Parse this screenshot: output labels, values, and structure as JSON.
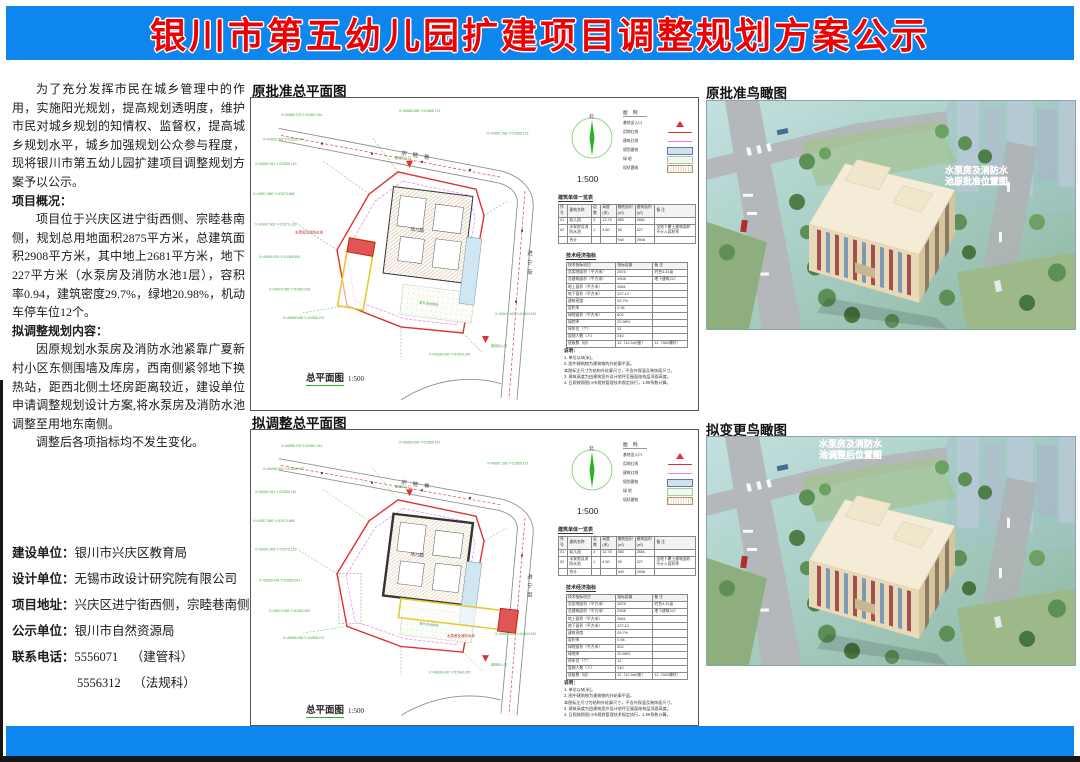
{
  "banner": {
    "title": "银川市第五幼儿园扩建项目调整规划方案公示",
    "bg_color": "#0d86ee",
    "title_color": "#ee0000"
  },
  "intro": {
    "p1": "为了充分发挥市民在城乡管理中的作用，实施阳光规划，提高规划透明度，维护市民对城乡规划的知情权、监督权，提高城乡规划水平，城乡加强规划公众参与程度，现将银川市第五幼儿园扩建项目调整规划方案予以公示。",
    "h1": "项目概况：",
    "p2": "项目位于兴庆区进宁街西侧、宗睦巷南侧，规划总用地面积2875平方米，总建筑面积2908平方米，其中地上2681平方米，地下227平方米（水泵房及消防水池1层），容积率0.94，建筑密度29.7%，绿地20.98%，机动车停车位12个。",
    "h2": "拟调整规划内容：",
    "p3": "因原规划水泵房及消防水池紧靠广夏新村小区东侧围墙及库房，西南侧紧邻地下换热站，距西北侧土坯房距离较近，建设单位申请调整规划设计方案,将水泵房及消防水池调整至用地东南侧。",
    "p4": "调整后各项指标均不发生变化。"
  },
  "info": {
    "rows": [
      [
        "建设单位：",
        "银川市兴庆区教育局"
      ],
      [
        "设计单位：",
        "无锡市政设计研究院有限公司"
      ],
      [
        "项目地址：",
        "兴庆区进宁街西侧，宗睦巷南侧"
      ],
      [
        "公示单位：",
        "银川市自然资源局"
      ]
    ],
    "phone_label": "联系电话：",
    "phone1": "5556071",
    "phone1_dept": "（建管科）",
    "phone2": "5556312",
    "phone2_dept": "（法规科）",
    "date_label": "公示时间：",
    "date_value": "2023年4月18日至2023年4月25日"
  },
  "sections": {
    "plan1": "原批准总平面图",
    "plan2": "拟调整总平面图",
    "bird1": "原批准鸟瞰图",
    "bird2": "拟变更鸟瞰图"
  },
  "plan": {
    "caption": "总平面图",
    "scale": "1:500",
    "north_label": "北",
    "streets": {
      "north": "宗睦巷",
      "east": "进宁街"
    },
    "entrance_label": "基地出入口",
    "building_label": "幼儿园",
    "pump_label": "水泵房及消防水池",
    "playground_label": "室外活动场地",
    "legend": {
      "title": "图 例",
      "items": [
        "基地出入口",
        "用地红线",
        "建筑红线",
        "规划建筑",
        "绿  地",
        "现状建筑"
      ]
    },
    "table1": {
      "title": "建筑单体一览表",
      "rows": [
        [
          "序号",
          "建筑名称",
          "层数",
          "高度(米)",
          "基底面积(㎡)",
          "建筑面积(㎡)",
          "备 注"
        ],
        [
          "01",
          "幼儿园",
          "3",
          "12.75",
          "850",
          "2681",
          ""
        ],
        [
          "02",
          "水泵房及消防水池",
          "1",
          "4.50",
          "90",
          "227",
          "全地下覆土建筑面积不计入容积率"
        ],
        [
          "",
          "合计",
          "",
          "",
          "940",
          "2908",
          ""
        ]
      ]
    },
    "table2": {
      "title": "技术经济指标",
      "rows": [
        [
          "技术指标项目",
          "指标容量",
          "备 注"
        ],
        [
          "总用地面积（平方米）",
          "2875",
          "约合4.31亩"
        ],
        [
          "总建筑面积（平方米）",
          "2908",
          "地下建筑227"
        ],
        [
          "地上面积（平方米）",
          "2681",
          ""
        ],
        [
          "地下面积（平方米）",
          "227.12",
          ""
        ],
        [
          "建筑密度",
          "29.7%",
          ""
        ],
        [
          "容积率",
          "0.94",
          ""
        ],
        [
          "绿地面积（平方米）",
          "602",
          ""
        ],
        [
          "绿地率",
          "20.98%",
          ""
        ],
        [
          "停车位（个）",
          "12",
          ""
        ],
        [
          "容纳人数（人）",
          "240",
          ""
        ],
        [
          "班级数（班）",
          "12（12.5㎡/座）",
          "12（360课时）"
        ]
      ]
    },
    "notes": {
      "title": "说明：",
      "items": [
        "1. 单位以M(米)。",
        "2. 图中建筑物为建筑物的外轮廓平面。",
        "本图标注尺寸为结构外轮廓尺寸，不含外保温及装饰面尺寸。",
        "3. 建筑高度为由建筑室外设计地坪至屋面结构层顶面高度。",
        "4. 日照按照银川市规划管理技术规定执行，1.99系数计算。"
      ]
    },
    "coords": [
      "X=40858.375 Y=51561.044",
      "X=40806.594 Y=51562.347",
      "X=40801.061 Y=51559.140",
      "X=40817.880 Y=51573.888",
      "X=40807.063 Y=51570.122",
      "X=40869.425 Y=51568.641",
      "X=40874.058 Y=51562.692",
      "X=40858.638 Y=51566.274",
      "X=40850.638 Y=51565.741",
      "X=40867.298 Y=51565.173",
      "X=40841.622 Y=51543.542",
      "X=40836.430 Y=51543.245"
    ]
  },
  "bird": {
    "annot_a": [
      "水泵房及消防水",
      "池原批准位置图"
    ],
    "annot_b": [
      "水泵房及消防水",
      "池调整后位置图"
    ]
  }
}
